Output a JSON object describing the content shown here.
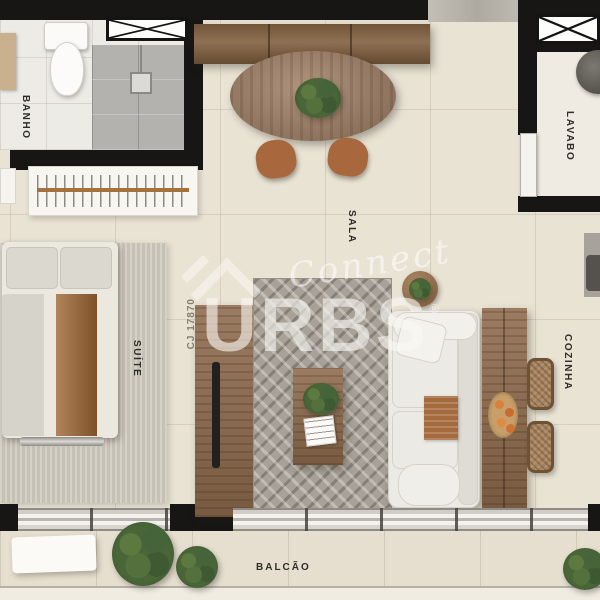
{
  "rooms": {
    "banho": {
      "label": "BANHO"
    },
    "lavabo": {
      "label": "LAVABO"
    },
    "sala": {
      "label": "SALA"
    },
    "suite": {
      "label": "SUÍTE"
    },
    "cozinha": {
      "label": "COZINHA"
    },
    "balcao": {
      "label": "BALCÃO"
    }
  },
  "watermark": {
    "brand": "URBS",
    "registered": "®",
    "script": "Connect",
    "license": "CJ 17870"
  },
  "colors": {
    "wall": "#171615",
    "floor": "#e9e3d4",
    "wood": "#8d6a4c",
    "rug": "#a7a197",
    "bed_throw": "#9e6533",
    "plant_green": "#4a6639",
    "sofa_white": "#eceae4"
  }
}
